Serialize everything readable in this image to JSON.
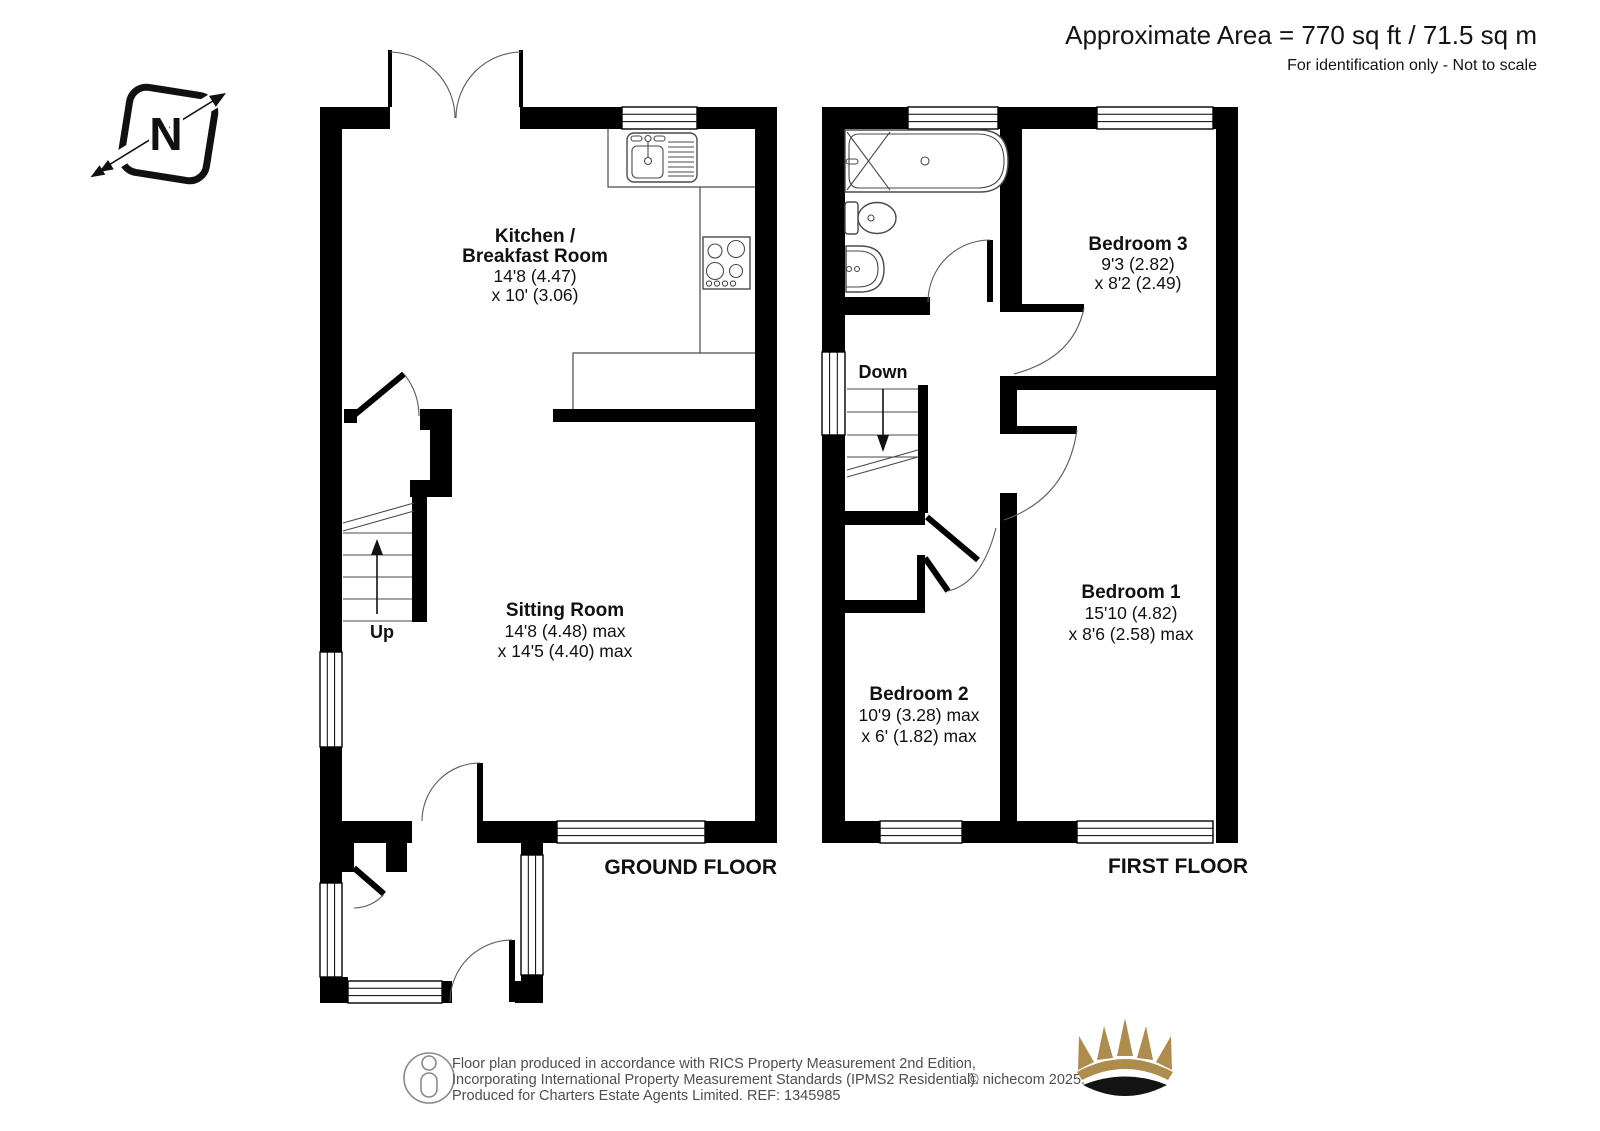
{
  "header": {
    "area": "Approximate Area = 770 sq ft / 71.5 sq m",
    "note": "For identification only - Not to scale"
  },
  "compass": {
    "label": "N"
  },
  "ground": {
    "title": "GROUND FLOOR",
    "up": "Up",
    "kitchen": {
      "l1": "Kitchen /",
      "l2": "Breakfast Room",
      "l3": "14'8 (4.47)",
      "l4": "x 10' (3.06)"
    },
    "sitting": {
      "l1": "Sitting Room",
      "l2": "14'8 (4.48) max",
      "l3": "x 14'5 (4.40) max"
    }
  },
  "first": {
    "title": "FIRST FLOOR",
    "down": "Down",
    "bed3": {
      "l1": "Bedroom 3",
      "l2": "9'3 (2.82)",
      "l3": "x 8'2 (2.49)"
    },
    "bed1": {
      "l1": "Bedroom 1",
      "l2": "15'10 (4.82)",
      "l3": "x 8'6 (2.58) max"
    },
    "bed2": {
      "l1": "Bedroom 2",
      "l2": "10'9 (3.28) max",
      "l3": "x 6' (1.82) max"
    }
  },
  "footer": {
    "line1": "Floor plan produced in accordance with RICS Property Measurement 2nd Edition,",
    "line2": "Incorporating International Property Measurement Standards (IPMS2 Residential).",
    "credit": "© nichecom 2025.",
    "line3": "Produced for Charters Estate Agents Limited.   REF: 1345985"
  },
  "colors": {
    "wall": "#000000",
    "crown_gold": "#AE8C4D",
    "footer_text": "#4f4f4f"
  }
}
